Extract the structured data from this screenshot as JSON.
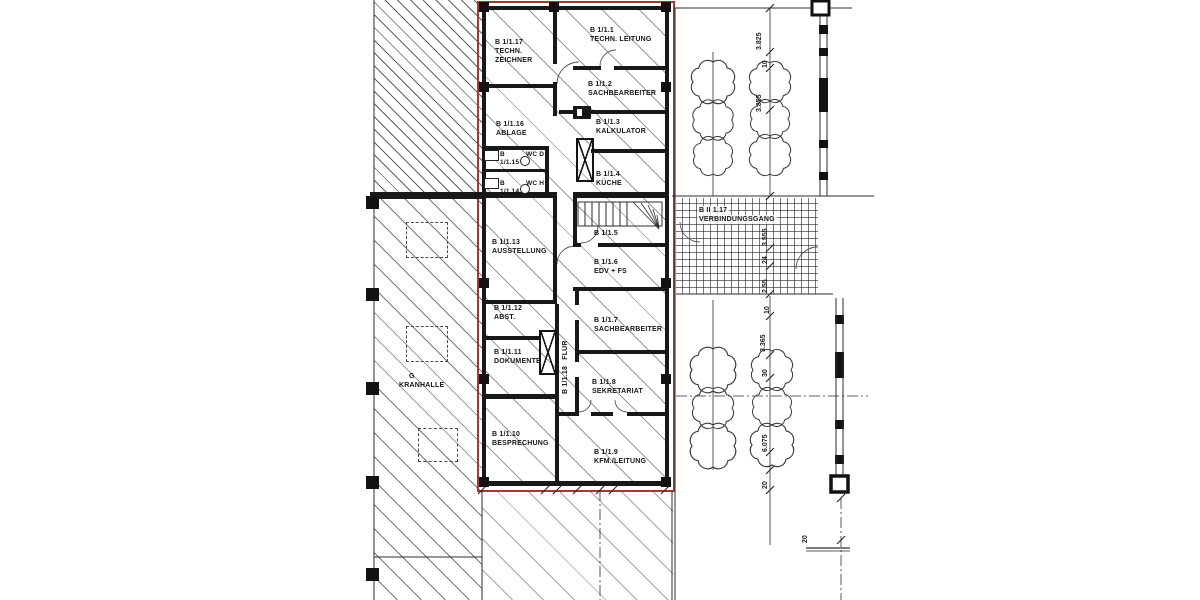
{
  "colors": {
    "boundary_red": "#a5392f",
    "ink": "#181818",
    "paper": "#ffffff"
  },
  "rooms": [
    {
      "id": "B 1/1.17",
      "name": "TECHN. ZEICHNER"
    },
    {
      "id": "B 1/1.1",
      "name": "TECHN. LEITUNG"
    },
    {
      "id": "B 1/1.2",
      "name": "SACHBEARBEITER"
    },
    {
      "id": "B 1/1.16",
      "name": "ABLAGE"
    },
    {
      "id": "B 1/1.3",
      "name": "KALKULATOR"
    },
    {
      "id": "B 1/1.15",
      "name": "WC D"
    },
    {
      "id": "B 1/1.14",
      "name": "WC H"
    },
    {
      "id": "B 1/1.4",
      "name": "KÜCHE"
    },
    {
      "id": "B 1/1.5",
      "name": ""
    },
    {
      "id": "B 1/1.13",
      "name": "AUSSTELLUNG"
    },
    {
      "id": "B 1/1.6",
      "name": "EDV + FS"
    },
    {
      "id": "B 1/1.12",
      "name": "ABST."
    },
    {
      "id": "B 1/1.7",
      "name": "SACHBEARBEITER"
    },
    {
      "id": "B 1/1.11",
      "name": "DOKUMENTE"
    },
    {
      "id": "B 1/1.18",
      "name": "FLUR"
    },
    {
      "id": "B 1/1.8",
      "name": "SEKRETARIAT"
    },
    {
      "id": "B 1/1.10",
      "name": "BESPRECHUNG"
    },
    {
      "id": "B 1/1.9",
      "name": "KFM./LEITUNG"
    },
    {
      "id": "G",
      "name": "KRANHALLE"
    },
    {
      "id": "B II 1.17",
      "name": "VERBINDUNGSGANG"
    }
  ],
  "dimensions": {
    "right_top": [
      "3.825",
      "10",
      "3.855"
    ],
    "walkway": [
      "3.555",
      "24",
      "2.55"
    ],
    "right_bottom": [
      "10",
      "3.365",
      "30",
      "6.075",
      "20"
    ],
    "bottom_edge": [
      "20"
    ]
  }
}
